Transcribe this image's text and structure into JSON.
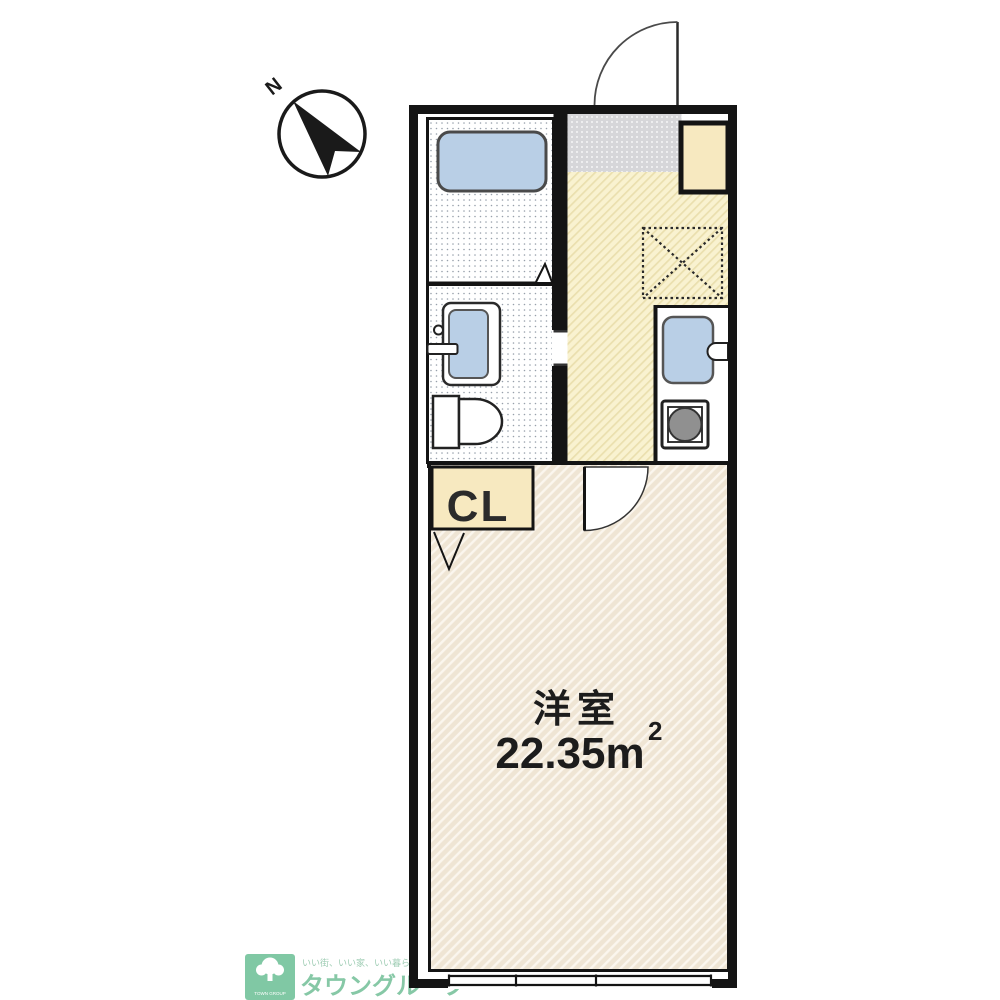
{
  "compass": {
    "north_label": "N"
  },
  "plan": {
    "closet_label": "CL",
    "room": {
      "name": "洋室",
      "area": "22.35m",
      "area_sup": "2"
    }
  },
  "logo": {
    "tagline": "いい街、いい家、いい暮らし",
    "brand": "タウングループ",
    "mark_caption": "TOWN GROUP"
  },
  "colors": {
    "wall": "#141414",
    "fixture_blue": "#b9cfe6",
    "cream": "#f7e9c0",
    "kitchen_floor": "#f9f2d0",
    "kitchen_hatch": "#eadfae",
    "room_floor": "#efe5d4",
    "room_hatch": "#fbf6ee",
    "entrance_gray": "#d6d6d9",
    "burner_gray": "#909090",
    "logo_green": "#80c8a4",
    "brand_green": "#86c8a6",
    "tagline_green": "#9fcdb4"
  }
}
